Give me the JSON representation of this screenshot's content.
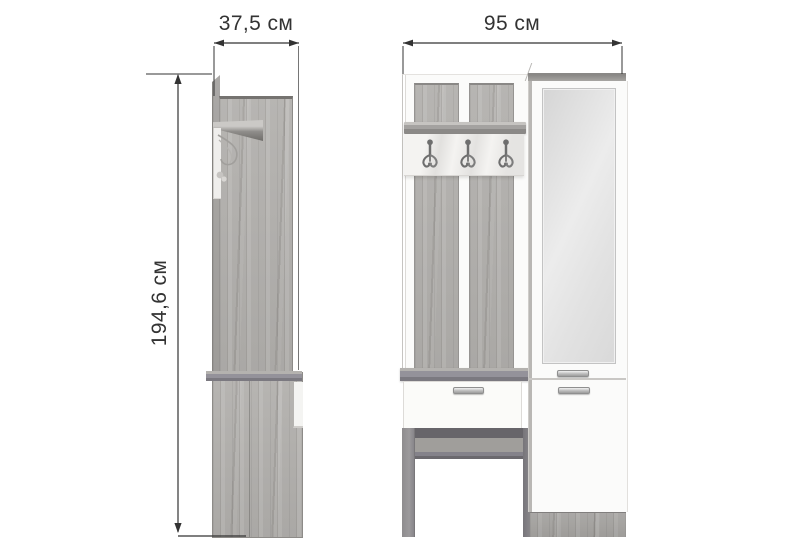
{
  "title": "furniture-dimension-diagram",
  "dimensions": {
    "depth": {
      "label": "37,5 см",
      "applies_to": "side-view"
    },
    "width": {
      "label": "95 см",
      "applies_to": "front-view"
    },
    "height": {
      "label": "194,6 см",
      "applies_to": "side-view"
    }
  },
  "views": {
    "side": {
      "parts": [
        "back-panel",
        "tall-wood-panel",
        "shelf-bracket",
        "wire-hook",
        "bench-cabinet",
        "counter-top",
        "drawer-edge"
      ]
    },
    "front": {
      "hook_count": 3,
      "parts": [
        "side-panel",
        "wood-panel",
        "wood-panel",
        "top-shelf",
        "hook-rail",
        "counter-top",
        "drawer",
        "open-niche",
        "legs",
        "mirror-door",
        "lower-door",
        "plinth"
      ]
    }
  },
  "colors": {
    "background": "#ffffff",
    "dim": "#333333",
    "wood": "#b3b1ae",
    "wood-edge": "#8e8c89",
    "counter": "#94929a",
    "counter-light": "#b4b2af",
    "counter-dark": "#7b7980",
    "niche-back": "#67656a",
    "niche-floor": "#a09e9b",
    "white-panel": "#fbfbfa",
    "mirror-a": "#d5d5d5",
    "mirror-b": "#ececec",
    "metal": "#6e6e6e",
    "wire": "#a19f9c"
  }
}
